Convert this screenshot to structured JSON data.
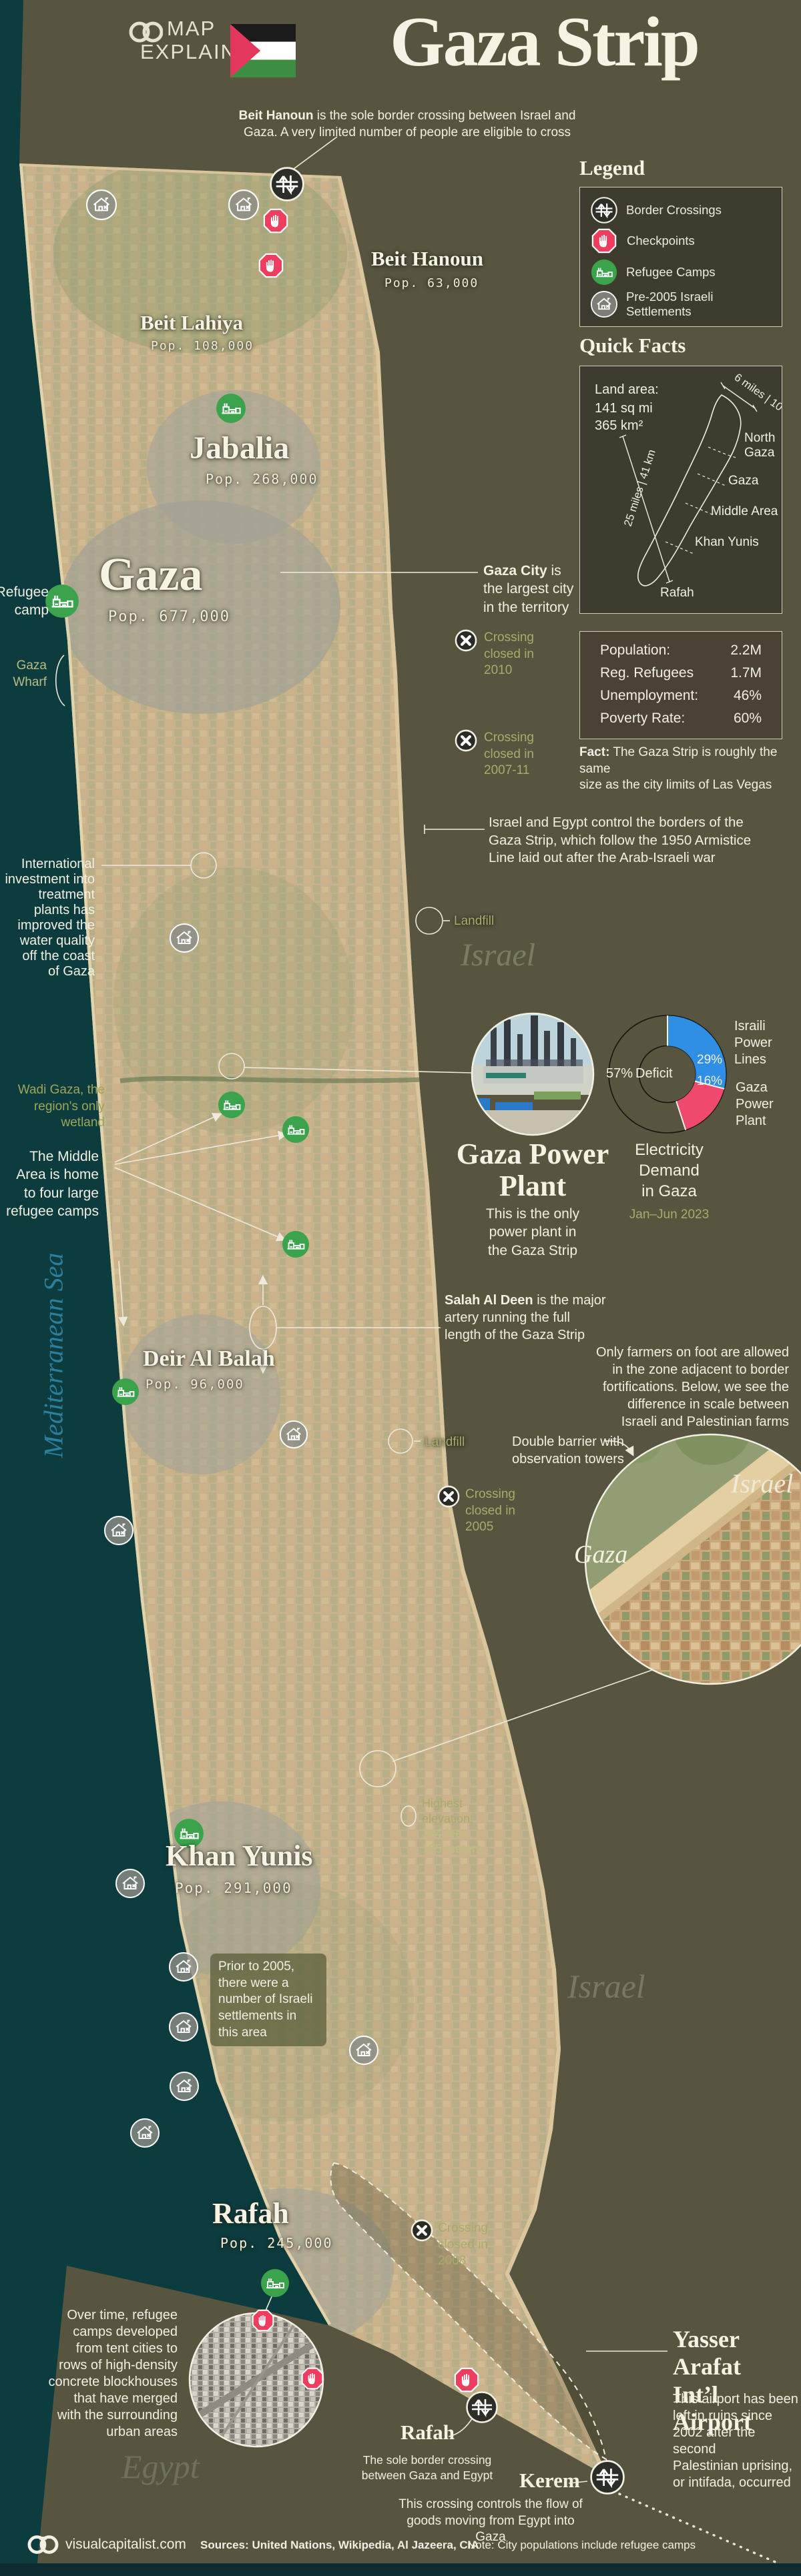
{
  "header": {
    "brand_line1": "MAP",
    "brand_line2": "EXPLAINER",
    "title": "Gaza Strip",
    "intro_lead": "Beit Hanoun",
    "intro_rest": " is the sole border crossing between Israel and",
    "intro_line2": "Gaza. A very limited number of people are eligible to cross"
  },
  "legend": {
    "title": "Legend",
    "items": [
      {
        "icon": "border-crossing-icon",
        "label": "Border Crossings"
      },
      {
        "icon": "checkpoint-icon",
        "label": "Checkpoints"
      },
      {
        "icon": "refugee-camp-icon",
        "label": "Refugee Camps"
      },
      {
        "icon": "settlement-icon",
        "label": "Pre-2005 Israeli Settlements"
      }
    ]
  },
  "quick_facts": {
    "title": "Quick Facts",
    "land_area_label": "Land area:",
    "land_area_mi": "141 sq mi",
    "land_area_km": "365 km²",
    "scale_width": "6 miles | 10 km",
    "scale_length": "25 miles | 41 km",
    "regions": {
      "north_l1": "North",
      "north_l2": "Gaza",
      "gaza": "Gaza",
      "middle": "Middle Area",
      "khan": "Khan Yunis",
      "rafah": "Rafah"
    },
    "stats": [
      {
        "label": "Population:",
        "value": "2.2M"
      },
      {
        "label": "Reg. Refugees",
        "value": "1.7M"
      },
      {
        "label": "Unemployment:",
        "value": "46%"
      },
      {
        "label": "Poverty Rate:",
        "value": "60%"
      }
    ],
    "fact_lead": "Fact:",
    "fact_l1": " The Gaza Strip is roughly the same",
    "fact_l2": "size as the city limits of Las Vegas"
  },
  "cities": {
    "beit_hanoun": {
      "name": "Beit Hanoun",
      "pop": "Pop. 63,000"
    },
    "beit_lahiya": {
      "name": "Beit Lahiya",
      "pop": "Pop. 108,000"
    },
    "jabalia": {
      "name": "Jabalia",
      "pop": "Pop. 268,000"
    },
    "gaza": {
      "name": "Gaza",
      "pop": "Pop. 677,000"
    },
    "deir_al_balah": {
      "name": "Deir Al Balah",
      "pop": "Pop. 96,000"
    },
    "khan_yunis": {
      "name": "Khan Yunis",
      "pop": "Pop. 291,000"
    },
    "rafah": {
      "name": "Rafah",
      "pop": "Pop. 245,000"
    }
  },
  "map": {
    "landfill_label": "Landfill",
    "refugee_callout": {
      "l1": "Refugee",
      "l2": "camp"
    },
    "wharf": {
      "l1": "Gaza",
      "l2": "Wharf"
    },
    "watermark_israel": "Israel",
    "watermark_egypt": "Egypt",
    "watermark_sea": "Mediterranean Sea",
    "inset_israel": "Israel",
    "inset_gaza": "Gaza"
  },
  "annotations": {
    "gaza_city": {
      "lead": "Gaza City",
      "l1rest": " is",
      "lines": [
        "the largest city",
        "in the territory"
      ]
    },
    "crossing_2010": {
      "lines": [
        "Crossing",
        "closed in",
        "2010"
      ]
    },
    "crossing_2007": {
      "lines": [
        "Crossing",
        "closed in",
        "2007-11"
      ]
    },
    "crossing_2005": {
      "lines": [
        "Crossing",
        "closed in",
        "2005"
      ]
    },
    "crossing_2008": {
      "lines": [
        "Crossing",
        "closed in",
        "2008"
      ]
    },
    "borders": {
      "lines": [
        "Israel and Egypt control the borders of the",
        "Gaza Strip, which follow the 1950 Armistice",
        "Line laid out after the Arab-Israeli war"
      ]
    },
    "investment": {
      "lines": [
        "International",
        "investment into",
        "treatment",
        "plants has",
        "improved the",
        "water quality",
        "off the coast",
        "of Gaza"
      ]
    },
    "wadi": {
      "lines": [
        "Wadi Gaza, the",
        "region's only",
        "wetland"
      ]
    },
    "middle_area": {
      "lines": [
        "The Middle",
        "Area is home",
        "to four large",
        "refugee camps"
      ]
    },
    "salah": {
      "lead": "Salah Al Deen",
      "l1rest": " is the major",
      "lines": [
        "artery running the full",
        "length of the Gaza Strip"
      ]
    },
    "farmers": {
      "lines": [
        "Only farmers on foot are allowed",
        "in the zone adjacent to border",
        "fortifications. Below, we see the",
        "difference in scale between",
        "Israeli and Palestinian farms"
      ]
    },
    "barrier": {
      "lines": [
        "Double barrier with",
        "observation towers"
      ]
    },
    "elevation": {
      "lines": [
        "Highest",
        "elevation:",
        "344 feet",
        "105 meters"
      ]
    },
    "prior_2005": {
      "lines": [
        "Prior to 2005,",
        "there were a",
        "number of Israeli",
        "settlements in",
        "this area"
      ]
    },
    "camps_growth": {
      "lines": [
        "Over time, refugee",
        "camps developed",
        "from tent cities to",
        "rows of high-density",
        "concrete blockhouses",
        "that have merged",
        "with the surrounding",
        "urban areas"
      ]
    }
  },
  "power_plant": {
    "title_l1": "Gaza Power",
    "title_l2": "Plant",
    "body_lines": [
      "This is the only",
      "power plant in",
      "the Gaza Strip"
    ]
  },
  "chart_data": {
    "type": "pie",
    "title": "Electricity Demand in Gaza",
    "subtitle": "Jan–Jun 2023",
    "slices": [
      {
        "label": "Deficit",
        "value": 57,
        "style": "outlined"
      },
      {
        "label": "Israili Power Lines",
        "value": 29,
        "color": "#2f8fe5"
      },
      {
        "label": "Gaza Power Plant",
        "value": 16,
        "color": "#ef4a6e"
      }
    ],
    "legend_position": "right",
    "labels": {
      "deficit_pct": "57%",
      "deficit": "Deficit",
      "blue_pct": "29%",
      "pink_pct": "16%",
      "blue_lines": [
        "Israili",
        "Power",
        "Lines"
      ],
      "pink_lines": [
        "Gaza",
        "Power",
        "Plant"
      ],
      "title_lines": [
        "Electricity",
        "Demand",
        "in Gaza"
      ]
    }
  },
  "airport": {
    "title_l1": "Yasser Arafat",
    "title_l2": "Int’l Airport",
    "body_lines": [
      "This airport has been",
      "left in ruins since",
      "2002 after the second",
      "Palestinian uprising,",
      "or intifada, occurred"
    ]
  },
  "rafah_crossing": {
    "title": "Rafah",
    "body_lines": [
      "The sole border crossing",
      "between Gaza and Egypt"
    ]
  },
  "kerem": {
    "title": "Kerem",
    "body_lines": [
      "This crossing controls the flow of",
      "goods moving from Egypt into Gaza"
    ]
  },
  "footer": {
    "site": "visualcapitalist.com",
    "sources": "Sources: United Nations, Wikipedia, Al Jazeera, CIA",
    "note": "Note: City populations include refugee camps"
  }
}
